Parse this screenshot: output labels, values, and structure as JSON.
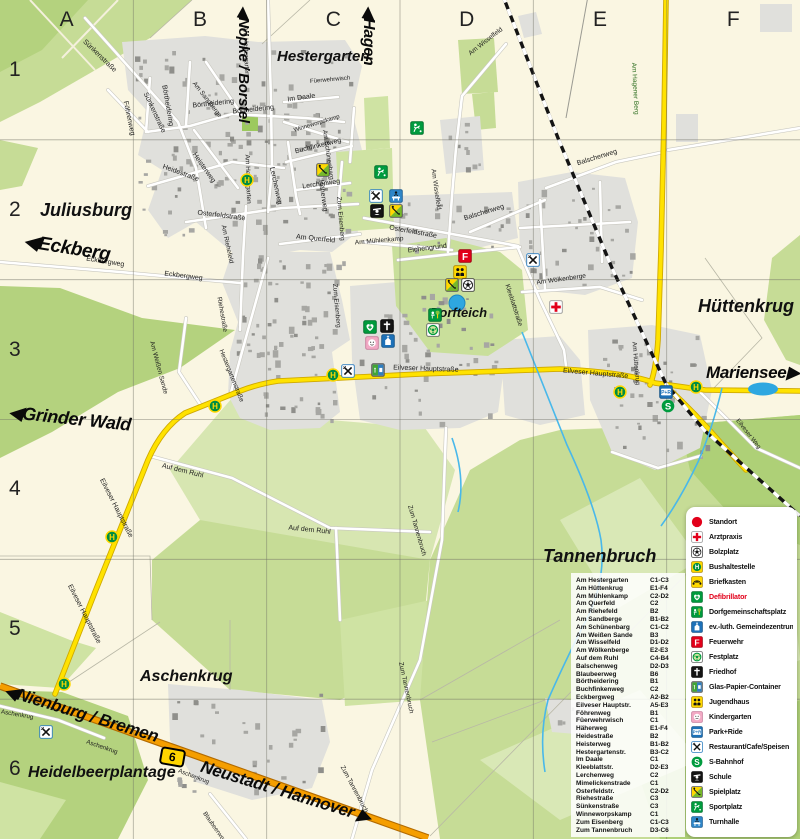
{
  "map": {
    "grid_columns": [
      "A",
      "B",
      "C",
      "D",
      "E",
      "F"
    ],
    "grid_rows": [
      "1",
      "2",
      "3",
      "4",
      "5",
      "6"
    ],
    "route_badge": "6",
    "direction_labels": [
      {
        "text": "◀Nöpke / Borstel",
        "x": 253,
        "y": 6,
        "rot": 90,
        "size": 15
      },
      {
        "text": "◀Hagen",
        "x": 379,
        "y": 6,
        "rot": 90,
        "size": 16
      },
      {
        "text": "◀Eckberg",
        "x": 26,
        "y": 230,
        "rot": 9,
        "size": 19
      },
      {
        "text": "◀Grinder Wald",
        "x": 10,
        "y": 402,
        "rot": 6,
        "size": 18
      },
      {
        "text": "◀Nienburg / Bremen",
        "x": 8,
        "y": 681,
        "rot": 17,
        "size": 17
      },
      {
        "text": "Neustadt / Hannover ▶",
        "x": 204,
        "y": 757,
        "rot": 17,
        "size": 17
      },
      {
        "text": "Mariensee▶",
        "x": 706,
        "y": 363,
        "rot": 0,
        "size": 17
      }
    ],
    "place_labels": [
      {
        "t": "Hestergarten",
        "x": 277,
        "y": 48,
        "s": 15
      },
      {
        "t": "Juliusburg",
        "x": 40,
        "y": 200,
        "s": 18
      },
      {
        "t": "Dorfteich",
        "x": 430,
        "y": 305,
        "s": 13
      },
      {
        "t": "Hüttenkrug",
        "x": 698,
        "y": 296,
        "s": 18
      },
      {
        "t": "Tannenbruch",
        "x": 543,
        "y": 546,
        "s": 18
      },
      {
        "t": "Aschenkrug",
        "x": 140,
        "y": 668,
        "s": 16
      },
      {
        "t": "Heidelbeerplantage",
        "x": 28,
        "y": 764,
        "s": 16
      }
    ],
    "street_labels": [
      {
        "t": "Sünkenstraße",
        "x": 108,
        "y": 42,
        "r": 44
      },
      {
        "t": "Sünkenstraße",
        "x": 170,
        "y": 95,
        "r": 65
      },
      {
        "t": "Börtheidering",
        "x": 188,
        "y": 88,
        "r": 80
      },
      {
        "t": "Börtheidering",
        "x": 213,
        "y": 106,
        "r": -6
      },
      {
        "t": "Börtheidering",
        "x": 253,
        "y": 112,
        "r": -6
      },
      {
        "t": "Föhrenweg",
        "x": 146,
        "y": 104,
        "r": 78
      },
      {
        "t": "Im Daale",
        "x": 301,
        "y": 100,
        "r": -8
      },
      {
        "t": "Winneworpskamp",
        "x": 317,
        "y": 131,
        "r": -17,
        "s": 6
      },
      {
        "t": "Buchfinkenweg",
        "x": 318,
        "y": 152,
        "r": -14
      },
      {
        "t": "Lerchenweg",
        "x": 294,
        "y": 170,
        "r": 78
      },
      {
        "t": "Lerchenweg",
        "x": 321,
        "y": 187,
        "r": -8
      },
      {
        "t": "Am Hestergarten",
        "x": 273,
        "y": 30,
        "r": 88,
        "s": 6.5
      },
      {
        "t": "Am Hestergarten",
        "x": 275,
        "y": 158,
        "r": 88,
        "s": 6.5
      },
      {
        "t": "Am Schünenbarg",
        "x": 353,
        "y": 133,
        "r": 82,
        "s": 6.5
      },
      {
        "t": "Häherweg",
        "x": 340,
        "y": 183,
        "r": 82
      },
      {
        "t": "Heisterweg",
        "x": 214,
        "y": 155,
        "r": 55
      },
      {
        "t": "Heidestraße",
        "x": 183,
        "y": 167,
        "r": 20
      },
      {
        "t": "Am Sandberge",
        "x": 218,
        "y": 84,
        "r": 52,
        "s": 6.5
      },
      {
        "t": "Füerwehrwisch",
        "x": 330,
        "y": 82,
        "r": -5,
        "s": 6
      },
      {
        "t": "Zum Eisenberg",
        "x": 364,
        "y": 200,
        "r": 85,
        "s": 6.5
      },
      {
        "t": "Zum Eisenberg",
        "x": 360,
        "y": 287,
        "r": 85,
        "s": 6.5
      },
      {
        "t": "Osterfeldstraße",
        "x": 222,
        "y": 213,
        "r": 7
      },
      {
        "t": "Osterfeldstraße",
        "x": 414,
        "y": 228,
        "r": 10
      },
      {
        "t": "Am Querfeld",
        "x": 316,
        "y": 237,
        "r": 6
      },
      {
        "t": "Am Mühlenkamp",
        "x": 379,
        "y": 243,
        "r": -5,
        "s": 6.5
      },
      {
        "t": "Eichengrund",
        "x": 427,
        "y": 251,
        "r": -7
      },
      {
        "t": "Am Riehefeld",
        "x": 246,
        "y": 228,
        "r": 78,
        "s": 6.5
      },
      {
        "t": "Riehestraße",
        "x": 240,
        "y": 300,
        "r": 80,
        "s": 6.5
      },
      {
        "t": "Hestergartenstraße",
        "x": 252,
        "y": 352,
        "r": 68,
        "s": 6.5
      },
      {
        "t": "Am Weißen Sande",
        "x": 182,
        "y": 344,
        "r": 75,
        "s": 6.5
      },
      {
        "t": "Am Wisselfeld",
        "x": 488,
        "y": 55,
        "r": -38,
        "s": 6.5
      },
      {
        "t": "Am Wisselfeld",
        "x": 457,
        "y": 172,
        "r": 82,
        "s": 6.5
      },
      {
        "t": "Balschenweg",
        "x": 597,
        "y": 164,
        "r": -17
      },
      {
        "t": "Balschenweg",
        "x": 484,
        "y": 219,
        "r": -17
      },
      {
        "t": "Kleeblattstraße",
        "x": 532,
        "y": 287,
        "r": 72,
        "s": 6.5
      },
      {
        "t": "Am Wölkenberge",
        "x": 561,
        "y": 283,
        "r": -8,
        "s": 6.5
      },
      {
        "t": "Eilveser Hauptstraße",
        "x": 426,
        "y": 368,
        "r": 2
      },
      {
        "t": "Eilveser Hauptstraße",
        "x": 596,
        "y": 371,
        "r": 5
      },
      {
        "t": "Eilveser Hauptstraße",
        "x": 137,
        "y": 481,
        "r": 63
      },
      {
        "t": "Eilveser Hauptstraße",
        "x": 105,
        "y": 587,
        "r": 63
      },
      {
        "t": "Am Hüttenkrug",
        "x": 659,
        "y": 345,
        "r": 85,
        "s": 6.5
      },
      {
        "t": "Am Hagener Berg",
        "x": 663,
        "y": 66,
        "r": 87,
        "s": 6.5,
        "c": "#2d6e1f"
      },
      {
        "t": "Auf dem Ruhl",
        "x": 184,
        "y": 466,
        "r": 14
      },
      {
        "t": "Auf dem Ruhl",
        "x": 310,
        "y": 528,
        "r": 6
      },
      {
        "t": "Zum Tannenbruch",
        "x": 439,
        "y": 508,
        "r": 74,
        "s": 6.5
      },
      {
        "t": "Zum Tannenbruch",
        "x": 430,
        "y": 665,
        "r": 78,
        "s": 6.5
      },
      {
        "t": "Zum Tannenbruch",
        "x": 371,
        "y": 768,
        "r": 62,
        "s": 6.5
      },
      {
        "t": "Eckbergweg",
        "x": 106,
        "y": 259,
        "r": 9
      },
      {
        "t": "Eckbergweg",
        "x": 184,
        "y": 274,
        "r": 7
      },
      {
        "t": "Aschenkrug",
        "x": 18,
        "y": 712,
        "r": 10,
        "s": 6.2
      },
      {
        "t": "Aschenkrug",
        "x": 104,
        "y": 742,
        "r": 19,
        "s": 6.2
      },
      {
        "t": "Aschenkrug",
        "x": 196,
        "y": 771,
        "r": 21,
        "s": 6.2
      },
      {
        "t": "Blaubeerweg",
        "x": 225,
        "y": 814,
        "r": 55,
        "s": 6.2
      },
      {
        "t": "Eilveser Weg",
        "x": 758,
        "y": 421,
        "r": 52,
        "s": 6.2
      }
    ],
    "icons": [
      {
        "type": "busstop",
        "x": 247,
        "y": 180
      },
      {
        "type": "busstop",
        "x": 333,
        "y": 375
      },
      {
        "type": "busstop",
        "x": 215,
        "y": 406
      },
      {
        "type": "busstop",
        "x": 112,
        "y": 537
      },
      {
        "type": "busstop",
        "x": 64,
        "y": 684
      },
      {
        "type": "busstop",
        "x": 620,
        "y": 392
      },
      {
        "type": "busstop",
        "x": 696,
        "y": 387
      },
      {
        "type": "spielplatz",
        "x": 323,
        "y": 170
      },
      {
        "type": "sportplatz",
        "x": 417,
        "y": 128
      },
      {
        "type": "sportplatz",
        "x": 381,
        "y": 172
      },
      {
        "type": "restaurant",
        "x": 376,
        "y": 196
      },
      {
        "type": "turnhalle",
        "x": 396,
        "y": 196
      },
      {
        "type": "schule",
        "x": 377,
        "y": 211
      },
      {
        "type": "spielplatz",
        "x": 396,
        "y": 211
      },
      {
        "type": "feuerwehr",
        "x": 465,
        "y": 256
      },
      {
        "type": "jugend",
        "x": 460,
        "y": 272
      },
      {
        "type": "spielplatz",
        "x": 452,
        "y": 285
      },
      {
        "type": "bolzplatz",
        "x": 468,
        "y": 285
      },
      {
        "type": "dorfgem",
        "x": 435,
        "y": 315
      },
      {
        "type": "festplatz",
        "x": 433,
        "y": 330
      },
      {
        "type": "defi",
        "x": 370,
        "y": 327
      },
      {
        "type": "friedhof",
        "x": 387,
        "y": 326
      },
      {
        "type": "kiga",
        "x": 372,
        "y": 343
      },
      {
        "type": "gemeinde",
        "x": 388,
        "y": 341
      },
      {
        "type": "restaurant",
        "x": 348,
        "y": 371
      },
      {
        "type": "glas",
        "x": 378,
        "y": 370
      },
      {
        "type": "restaurant",
        "x": 533,
        "y": 260
      },
      {
        "type": "arzt",
        "x": 556,
        "y": 307
      },
      {
        "type": "parkride",
        "x": 666,
        "y": 392
      },
      {
        "type": "sbahn",
        "x": 668,
        "y": 406
      },
      {
        "type": "restaurant",
        "x": 46,
        "y": 732
      }
    ]
  },
  "legend": {
    "items": [
      {
        "icon": "standort",
        "label": "Standort"
      },
      {
        "icon": "arzt",
        "label": "Arztpraxis"
      },
      {
        "icon": "bolzplatz",
        "label": "Bolzplatz"
      },
      {
        "icon": "bus",
        "label": "Bushaltestelle"
      },
      {
        "icon": "briefkasten",
        "label": "Briefkasten"
      },
      {
        "icon": "defi",
        "label": "Defibrillator",
        "color": "#e2001a"
      },
      {
        "icon": "dorfgem",
        "label": "Dorfgemeinschaftsplatz"
      },
      {
        "icon": "gemeinde",
        "label": "ev.-luth. Gemeindezentrum"
      },
      {
        "icon": "feuerwehr",
        "label": "Feuerwehr"
      },
      {
        "icon": "festplatz",
        "label": "Festplatz"
      },
      {
        "icon": "friedhof",
        "label": "Friedhof"
      },
      {
        "icon": "glas",
        "label": "Glas-Papier-Container"
      },
      {
        "icon": "jugend",
        "label": "Jugendhaus"
      },
      {
        "icon": "kiga",
        "label": "Kindergarten"
      },
      {
        "icon": "parkride",
        "label": "Park+Ride"
      },
      {
        "icon": "restaurant",
        "label": "Restaurant/Cafe/Speisen"
      },
      {
        "icon": "sbahn",
        "label": "S-Bahnhof"
      },
      {
        "icon": "schule",
        "label": "Schule"
      },
      {
        "icon": "spielplatz",
        "label": "Spielplatz"
      },
      {
        "icon": "sportplatz",
        "label": "Sportplatz"
      },
      {
        "icon": "turnhalle",
        "label": "Turnhalle"
      }
    ]
  },
  "street_index": {
    "entries": [
      [
        "Am Hestergarten",
        "C1-C3"
      ],
      [
        "Am Hüttenkrug",
        "E1-F4"
      ],
      [
        "Am Mühlenkamp",
        "C2-D2"
      ],
      [
        "Am Querfeld",
        "C2"
      ],
      [
        "Am Riehefeld",
        "B2"
      ],
      [
        "Am Sandberge",
        "B1-B2"
      ],
      [
        "Am Schünenbarg",
        "C1-C2"
      ],
      [
        "Am Weißen Sande",
        "B3"
      ],
      [
        "Am Wisselfeld",
        "D1-D2"
      ],
      [
        "Am Wölkenberge",
        "E2-E3"
      ],
      [
        "Auf dem Ruhl",
        "C4-B4"
      ],
      [
        "Balschenweg",
        "D2-D3"
      ],
      [
        "Blaubeerweg",
        "B6"
      ],
      [
        "Börtheidering",
        "B1"
      ],
      [
        "Buchfinkenweg",
        "C2"
      ],
      [
        "Eckbergweg",
        "A2-B2"
      ],
      [
        "Eilveser Hauptstr.",
        "A5-E3"
      ],
      [
        "Föhrenweg",
        "B1"
      ],
      [
        "Füerwehrwisch",
        "C1"
      ],
      [
        "Häherweg",
        "E1-F4"
      ],
      [
        "Heidestraße",
        "B2"
      ],
      [
        "Heisterweg",
        "B1-B2"
      ],
      [
        "Hestergartenstr.",
        "B3-C2"
      ],
      [
        "Im Daale",
        "C1"
      ],
      [
        "Kleeblattstr.",
        "D2-E3"
      ],
      [
        "Lerchenweg",
        "C2"
      ],
      [
        "Mimelickenstrade",
        "C1"
      ],
      [
        "Osterfeldstr.",
        "C2-D2"
      ],
      [
        "Riehestraße",
        "C3"
      ],
      [
        "Sünkenstraße",
        "C3"
      ],
      [
        "Winneworpskamp",
        "C1"
      ],
      [
        "Zum Eisenberg",
        "C1-C3"
      ],
      [
        "Zum Tannenbruch",
        "D3-C6"
      ]
    ]
  },
  "colors": {
    "accent_red": "#e2001a",
    "road_yellow": "#ffe200",
    "road_orange": "#f59e00",
    "water": "#49b8ea",
    "forest": "#c6dc96"
  }
}
